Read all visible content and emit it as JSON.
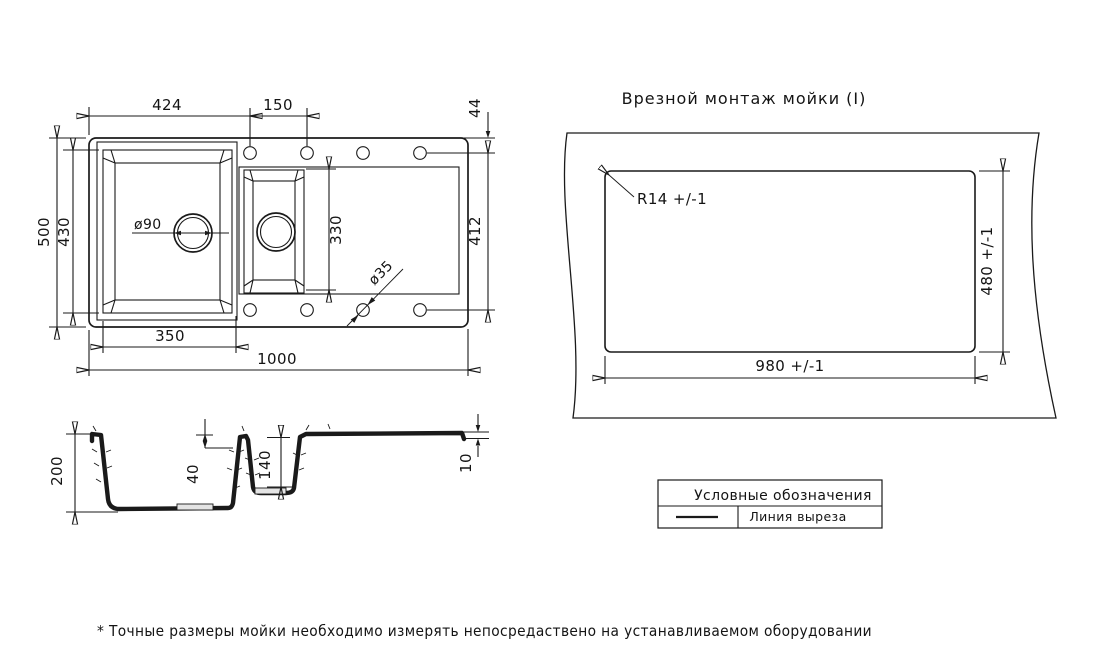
{
  "plan_view": {
    "dim_edge_to_first_hole": "424",
    "dim_hole_pitch": "150",
    "dim_top_edge_to_holes": "44",
    "dim_overall_depth": "500",
    "dim_main_bowl_depth": "430",
    "dim_small_section_depth": "330",
    "dim_hole_row_span": "412",
    "dim_main_bowl_width": "350",
    "dim_overall_width": "1000",
    "main_drain_label": "ø90",
    "faucet_hole_label": "ø35"
  },
  "section_view": {
    "dim_bowl_depth": "200",
    "dim_divider_drop": "40",
    "dim_small_bowl_depth": "140",
    "dim_rim_thickness": "10"
  },
  "cutout_view": {
    "title": "Врезной монтаж мойки (I)",
    "corner_radius_label": "R14 +/-1",
    "dim_cutout_width": "980 +/-1",
    "dim_cutout_height": "480 +/-1"
  },
  "legend": {
    "title": "Условные обозначения",
    "cut_line_label": "Линия выреза"
  },
  "footnote": "* Точные размеры мойки необходимо измерять непосредаствено на устанавливаемом оборудовании",
  "colors": {
    "cut_line": "#e23b3b",
    "line": "#1a1a1a"
  }
}
